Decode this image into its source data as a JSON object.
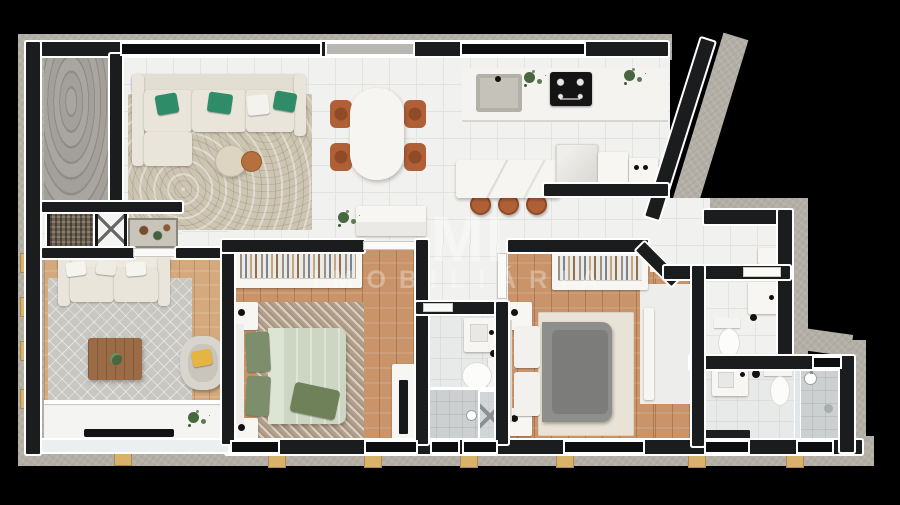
{
  "watermark": {
    "logo": "MI",
    "label": "IMOBILIÁRIA"
  },
  "palette": {
    "background": "#000000",
    "slab": "#b3afa6",
    "wall": "#1a1c1e",
    "outline": "#ffffff",
    "tile": "#f1f1ef",
    "tile_line": "#e3e3e0",
    "bath_tile": "#e8e9e9",
    "shower_tile": "#cdd0d1",
    "wood": "#c9946a",
    "wood_office": "#d4a97e",
    "rug_living": "#cdc4b2",
    "rug_bedroom": "#b3a08c",
    "rug_master": "#e8e3d6",
    "rug_office": "#c9c7c2",
    "sofa_cream": "#e9e5da",
    "pillow_green": "#2f8c68",
    "bed_sage": "#ccd6c3",
    "pillow_sage": "#7c8e6c",
    "throw_green": "#6e8159",
    "bed_gray": "#8e8e8c",
    "chair_wood": "#b06036",
    "table_wood": "#9a6b45",
    "plant_green": "#48663f",
    "pillow_yellow": "#e5b544",
    "peg_wood": "#d9b06c",
    "window_glass": "#0b0d0e",
    "window_light": "#b8b7b3",
    "appliance_black": "#141414",
    "steel": "#c5c2b9",
    "door_white": "#fafaf8"
  }
}
